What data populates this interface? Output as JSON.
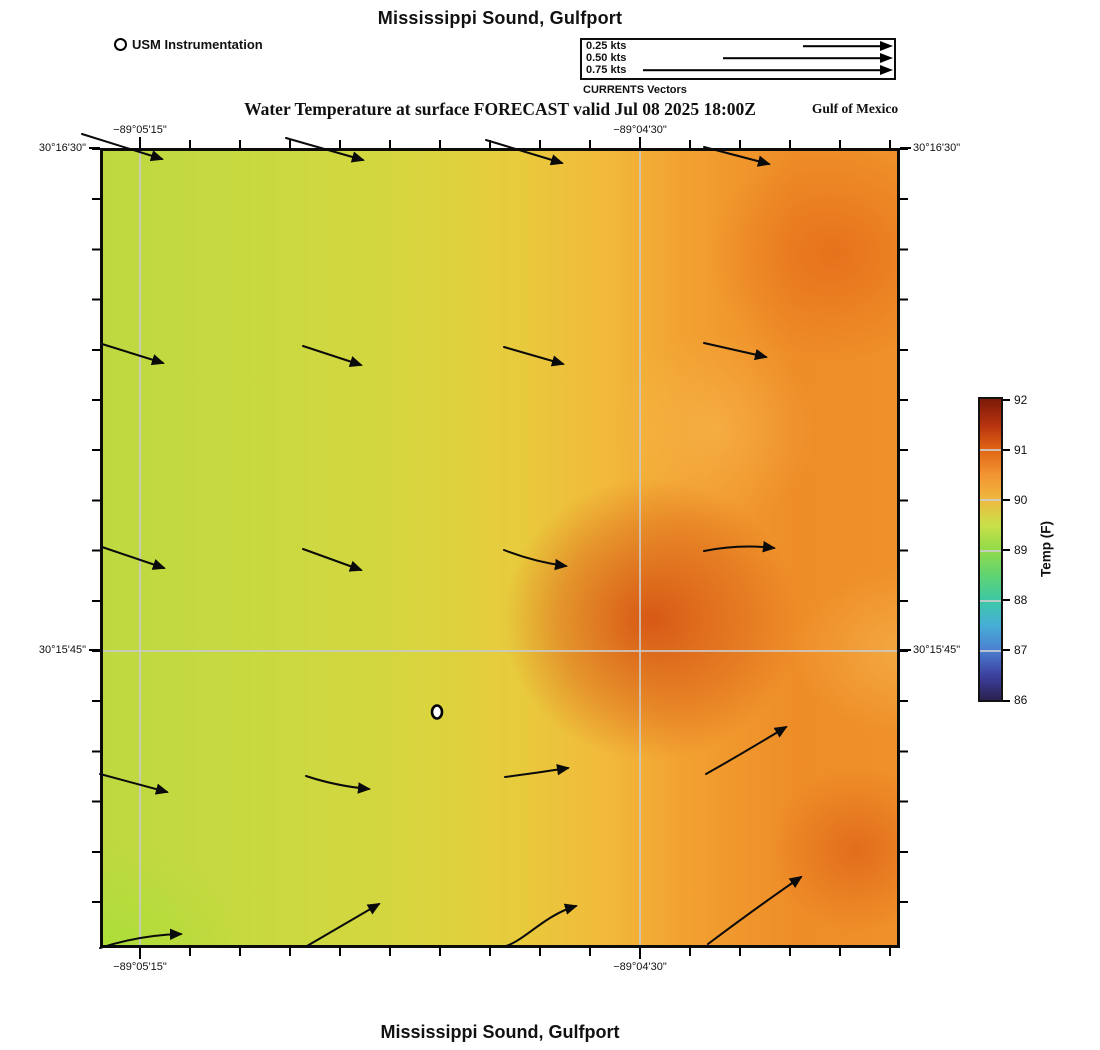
{
  "page": {
    "top_title": "Mississippi Sound, Gulfport",
    "bottom_title": "Mississippi Sound, Gulfport",
    "subtitle": "Water Temperature at surface FORECAST valid Jul 08 2025 18:00Z",
    "region_label": "Gulf of Mexico"
  },
  "station_legend": {
    "label": "USM Instrumentation"
  },
  "currents_legend": {
    "caption": "CURRENTS Vectors",
    "items": [
      {
        "label": "0.25 kts",
        "speed_kts": 0.25
      },
      {
        "label": "0.50 kts",
        "speed_kts": 0.5
      },
      {
        "label": "0.75 kts",
        "speed_kts": 0.75
      }
    ]
  },
  "axes": {
    "x_top": [
      "−89°05'15\"",
      "−89°04'30\""
    ],
    "x_bottom": [
      "−89°05'15\"",
      "−89°04'30\""
    ],
    "y_left": [
      "30°16'30\"",
      "30°15'45\""
    ],
    "y_right": [
      "30°16'30\"",
      "30°15'45\""
    ]
  },
  "colorbar": {
    "title": "Temp (F)",
    "ticks": [
      "92",
      "91",
      "90",
      "89",
      "88",
      "87",
      "86"
    ]
  },
  "colors": {
    "field_low": "#bed940",
    "field_mid": "#e8cb3d",
    "field_high": "#d24a10",
    "gridline": "#c9c9c9",
    "colorbar_min": "#2b2150",
    "colorbar_max": "#7c1a08"
  },
  "chart_data": {
    "type": "heatmap",
    "title": "Mississippi Sound, Gulfport",
    "subtitle": "Water Temperature at surface FORECAST valid Jul 08 2025 18:00Z",
    "region": "Gulf of Mexico",
    "x_ticks": [
      "−89°05'15\"",
      "−89°04'30\""
    ],
    "y_ticks": [
      "30°16'30\"",
      "30°15'45\""
    ],
    "grid": true,
    "colorbar": {
      "label": "Temp (F)",
      "min": 86,
      "max": 92,
      "ticks": [
        92,
        91,
        90,
        89,
        88,
        87,
        86
      ]
    },
    "temperature_field_F": {
      "note": "approximate surface temperatures read from the color field on a 5x5 grid, west-to-east within rows, north-to-south rows",
      "rows": [
        [
          89.3,
          89.5,
          89.8,
          90.3,
          90.9
        ],
        [
          89.3,
          89.5,
          89.9,
          90.6,
          91.0
        ],
        [
          89.4,
          89.6,
          90.1,
          91.1,
          90.5
        ],
        [
          89.3,
          89.6,
          90.1,
          91.0,
          90.8
        ],
        [
          89.0,
          89.4,
          89.9,
          90.3,
          90.7
        ]
      ]
    },
    "current_vectors": {
      "units": "kts",
      "legend_speeds": [
        0.25,
        0.5,
        0.75
      ],
      "layout": "4 columns x 5 rows of arrows",
      "approx_speed_kts": 0.2,
      "direction": "generally eastward; turning northeastward along the southern and southeastern edge"
    },
    "stations": [
      {
        "name": "USM Instrumentation",
        "marker": "white circle with black outline",
        "approx_location": "south-central area of map"
      }
    ]
  }
}
